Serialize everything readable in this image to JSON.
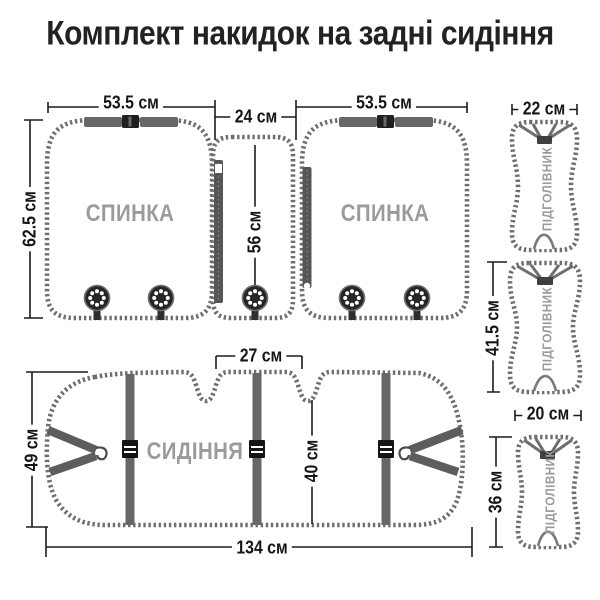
{
  "title": "Комплект накидок на задні сидіння",
  "colors": {
    "outline_stitch": "#6e6e6e",
    "dimension_lines": "#1c1c1c",
    "muted_part_label": "#9b9b9b",
    "strap": "#676767",
    "title_text": "#222222",
    "background": "#ffffff"
  },
  "diagram": {
    "backrest_left": {
      "name": "СПИНКА",
      "width": "53.5 см",
      "height": "62.5 см"
    },
    "center_section": {
      "width": "24 см",
      "height": "56 см"
    },
    "backrest_right": {
      "name": "СПИНКА",
      "width": "53.5 см"
    },
    "headrest_top": {
      "name": "ПІДГОЛІВНИК",
      "width": "22 см"
    },
    "headrest_middle": {
      "name": "ПІДГОЛІВНИК",
      "height": "41.5 см"
    },
    "headrest_bottom": {
      "name": "ПІДГОЛІВНИК",
      "width": "20 см",
      "height": "36 см"
    },
    "seat": {
      "name": "СИДІННЯ",
      "width": "134 см",
      "height": "49 см",
      "center_top_width": "27 см",
      "inner_height": "40 см"
    }
  }
}
